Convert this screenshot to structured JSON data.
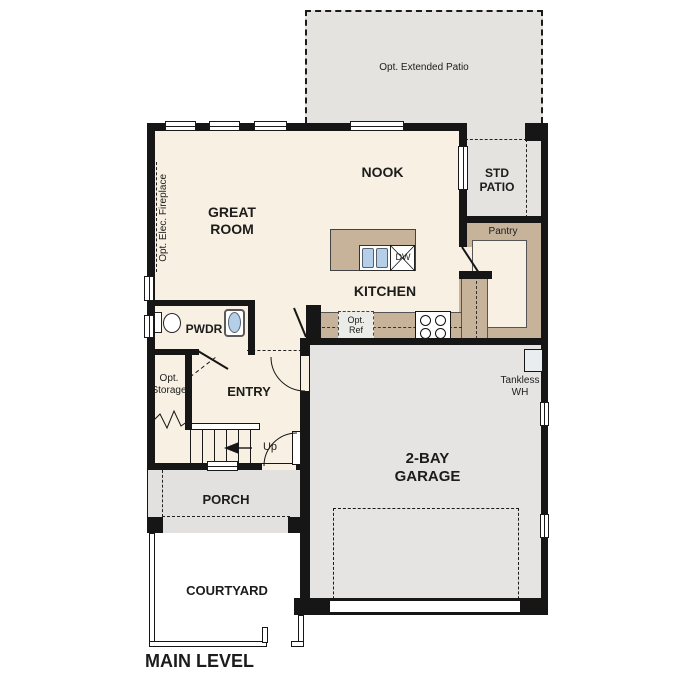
{
  "plan": {
    "title": "MAIN LEVEL",
    "rooms": {
      "extended_patio": "Opt. Extended Patio",
      "nook": "NOOK",
      "std_patio": "STD\nPATIO",
      "great_room": "GREAT\nROOM",
      "fireplace": "Opt. Elec. Fireplace",
      "pantry": "Pantry",
      "kitchen": "KITCHEN",
      "pwdr": "PWDR",
      "storage": "Opt.\nStorage",
      "entry": "ENTRY",
      "garage": "2-BAY\nGARAGE",
      "porch": "PORCH",
      "courtyard": "COURTYARD"
    },
    "fixtures": {
      "dishwasher": "DW",
      "ref": "Opt.\nRef",
      "tankless": "Tankless\nWH",
      "stairs_up": "Up"
    },
    "colors": {
      "wall": "#161616",
      "floor": "#f8f0e2",
      "counter": "#c7b39a",
      "patio_gray": "#e4e3e0",
      "sink_blue": "#b5cfe9",
      "text": "#1c1c1c"
    }
  }
}
